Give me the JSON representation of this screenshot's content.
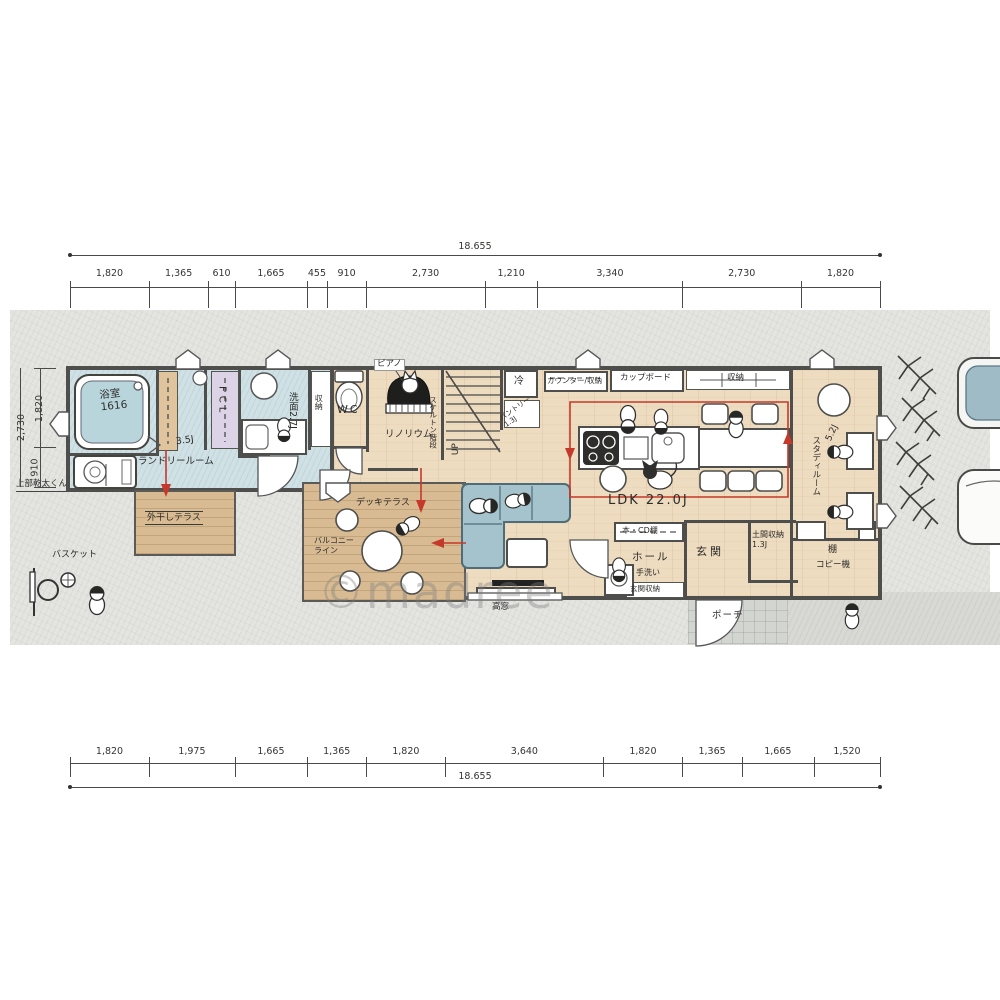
{
  "watermark": "©madree",
  "dimensions": {
    "top": {
      "total": "18.655",
      "segments": [
        "1,820",
        "1,365",
        "610",
        "1,665",
        "455",
        "910",
        "2,730",
        "1,210",
        "3,340",
        "2,730",
        "1,820"
      ],
      "mm": [
        1820,
        1365,
        610,
        1665,
        455,
        910,
        2730,
        1210,
        3340,
        2730,
        1820
      ]
    },
    "bottom": {
      "total": "18.655",
      "segments": [
        "1,820",
        "1,975",
        "1,665",
        "1,365",
        "1,820",
        "3,640",
        "1,820",
        "1,365",
        "1,665",
        "1,520"
      ],
      "mm": [
        1820,
        1975,
        1665,
        1365,
        1820,
        3640,
        1820,
        1365,
        1665,
        1520
      ]
    },
    "left": {
      "total": "2,730",
      "segments": [
        "1,820",
        "910"
      ],
      "mm": [
        1820,
        910
      ]
    }
  },
  "rooms": {
    "bath": {
      "name": "浴室",
      "size": "1616"
    },
    "laundry": {
      "name": "ランドリールーム",
      "size": "3.5J"
    },
    "fcl": {
      "name": "FCL"
    },
    "washroom": {
      "name": "洗面",
      "size": "2.7J"
    },
    "closet1": {
      "name": "収納"
    },
    "wc": {
      "name": "WC"
    },
    "linoleum": {
      "name": "リノリウム"
    },
    "piano": {
      "name": "ピアノ"
    },
    "stairs": {
      "name": "スケルトン階段",
      "up": "UP"
    },
    "fridge": {
      "name": "冷"
    },
    "pantry": {
      "name": "パントリー",
      "size": "1.3J"
    },
    "counter": {
      "name": "カウンター/収納"
    },
    "cupboard": {
      "name": "カップボード"
    },
    "closet_top": {
      "name": "収納"
    },
    "ldk": {
      "name": "LDK",
      "size": "22.0J"
    },
    "study": {
      "name": "スタディルーム",
      "size": "5.2J"
    },
    "shelf": {
      "name": "棚"
    },
    "copier": {
      "name": "コピー機"
    },
    "bookshelf": {
      "name": "本・CD棚"
    },
    "hall": {
      "name": "ホール"
    },
    "handwash": {
      "name": "手洗い"
    },
    "genkan": {
      "name": "玄関"
    },
    "doma": {
      "name": "土間収納",
      "size": "1.3J"
    },
    "genkan_storage": {
      "name": "玄関収納"
    },
    "porch": {
      "name": "ポーチ"
    },
    "deck": {
      "name": "デッキテラス"
    },
    "balcony": {
      "line1": "バルコニー",
      "line2": "ライン"
    },
    "drying": {
      "name": "外干しテラス"
    },
    "high_window": {
      "name": "高窓"
    },
    "basket": {
      "name": "バスケット"
    },
    "dryer_note": {
      "name": "上部乾太くん"
    }
  },
  "colors": {
    "accent_red": "#c5392b",
    "water_blue": "#cfe1e5",
    "wood": "#eedcc0",
    "deck_tan": "#d8bb92"
  }
}
